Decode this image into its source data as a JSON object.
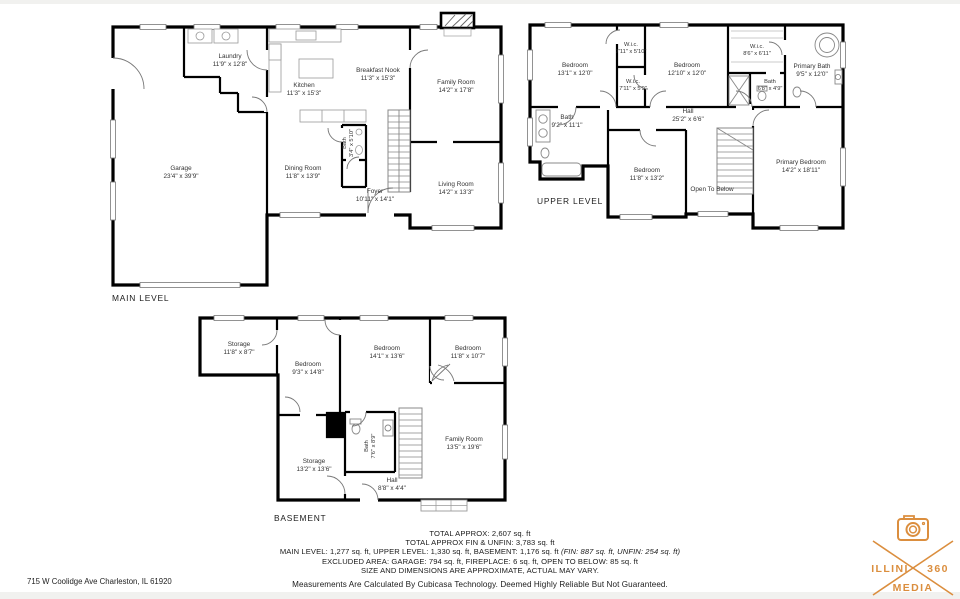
{
  "levels": {
    "main": {
      "label": "MAIN LEVEL",
      "rooms": {
        "laundry": {
          "name": "Laundry",
          "dims": "11'9\" x 12'8\""
        },
        "kitchen": {
          "name": "Kitchen",
          "dims": "11'3\" x 15'3\""
        },
        "breakfast_nook": {
          "name": "Breakfast Nook",
          "dims": "11'3\" x 15'3\""
        },
        "family_room": {
          "name": "Family Room",
          "dims": "14'2\" x 17'8\""
        },
        "garage": {
          "name": "Garage",
          "dims": "23'4\" x 39'9\""
        },
        "dining_room": {
          "name": "Dining Room",
          "dims": "11'8\" x 13'9\""
        },
        "bath": {
          "name": "Bath",
          "dims": "3'4\" x 5'10\""
        },
        "foyer": {
          "name": "Foyer",
          "dims": "10'11\" x 14'1\""
        },
        "living_room": {
          "name": "Living Room",
          "dims": "14'2\" x 13'3\""
        }
      }
    },
    "upper": {
      "label": "UPPER LEVEL",
      "rooms": {
        "bedroom1": {
          "name": "Bedroom",
          "dims": "13'1\" x 12'0\""
        },
        "wic1": {
          "name": "W.i.c.",
          "dims": "7'11\" x 5'10\""
        },
        "bedroom2": {
          "name": "Bedroom",
          "dims": "12'10\" x 12'0\""
        },
        "wic2": {
          "name": "W.i.c.",
          "dims": "8'6\" x 6'11\""
        },
        "primary_bath": {
          "name": "Primary Bath",
          "dims": "9'5\" x 12'0\""
        },
        "wic3": {
          "name": "W.i.c.",
          "dims": "7'11\" x 5'9\""
        },
        "bath_small": {
          "name": "Bath",
          "dims": "6'8\" x 4'9\""
        },
        "hall": {
          "name": "Hall",
          "dims": "25'2\" x 6'6\""
        },
        "bath": {
          "name": "Bath",
          "dims": "9'2\" x 11'1\""
        },
        "bedroom3": {
          "name": "Bedroom",
          "dims": "11'8\" x 13'2\""
        },
        "open_to_below": {
          "name": "Open To Below"
        },
        "primary_bedroom": {
          "name": "Primary Bedroom",
          "dims": "14'2\" x 18'11\""
        }
      }
    },
    "basement": {
      "label": "BASEMENT",
      "rooms": {
        "storage1": {
          "name": "Storage",
          "dims": "11'8\" x 8'7\""
        },
        "bedroom1": {
          "name": "Bedroom",
          "dims": "9'3\" x 14'8\""
        },
        "bedroom2": {
          "name": "Bedroom",
          "dims": "14'1\" x 13'6\""
        },
        "bedroom3": {
          "name": "Bedroom",
          "dims": "11'8\" x 10'7\""
        },
        "storage2": {
          "name": "Storage",
          "dims": "13'2\" x 13'6\""
        },
        "bath": {
          "name": "Bath",
          "dims": "7'6\" x 8'9\""
        },
        "family_room": {
          "name": "Family Room",
          "dims": "13'5\" x 19'6\""
        },
        "hall": {
          "name": "Hall",
          "dims": "8'8\" x 4'4\""
        }
      }
    }
  },
  "summary": {
    "line1": "TOTAL APPROX: 2,607 sq. ft",
    "line2": "TOTAL APPROX FIN & UNFIN: 3,783 sq. ft",
    "line3_regular": "MAIN LEVEL: 1,277 sq. ft, UPPER LEVEL: 1,330 sq. ft, BASEMENT: 1,176 sq. ft ",
    "line3_italic": "(FIN: 887 sq. ft, UNFIN: 254 sq. ft)",
    "line4": "EXCLUDED AREA: GARAGE: 794 sq. ft, FIREPLACE: 6 sq. ft, OPEN TO BELOW: 85 sq. ft",
    "line5": "SIZE AND DIMENSIONS ARE APPROXIMATE, ACTUAL MAY VARY.",
    "disclaimer": "Measurements Are Calculated By Cubicasa Technology. Deemed Highly Reliable But Not Guaranteed."
  },
  "address": "715 W Coolidge Ave Charleston, IL  61920",
  "logo": {
    "word1": "ILLINI",
    "word2": "360",
    "word3": "MEDIA",
    "color": "#DB8E3E"
  }
}
